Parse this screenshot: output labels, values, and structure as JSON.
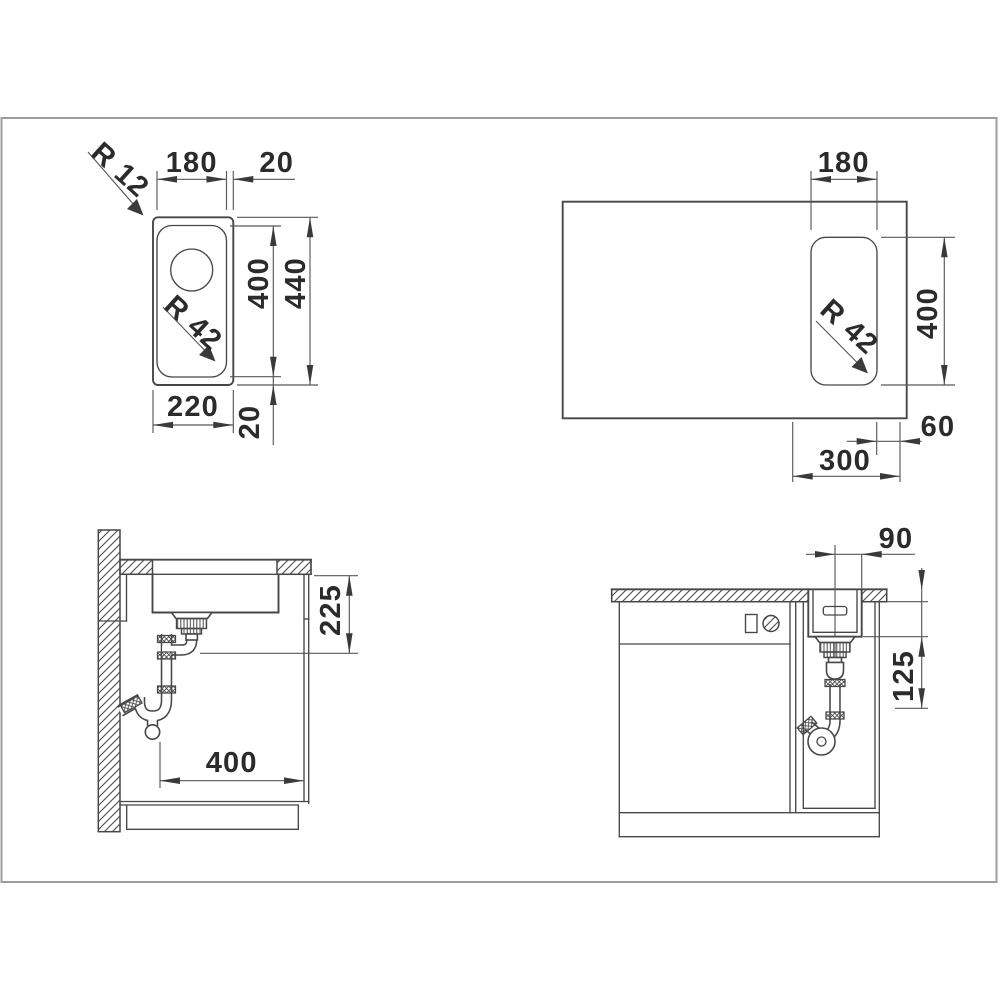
{
  "colors": {
    "line": "#474747",
    "dimension": "#585858",
    "text": "#2b2b2b",
    "panel_border": "#9d9d9d",
    "background": "#ffffff"
  },
  "views": {
    "top": {
      "title": "sink plan view",
      "dims": {
        "bowl_width": "180",
        "rim_offset_right": "20",
        "outer_corner_radius": "R 12",
        "bowl_corner_radius": "R 42",
        "bowl_length": "400",
        "outer_length": "440",
        "outer_width": "220",
        "rim_offset_bottom": "20"
      }
    },
    "cutout": {
      "title": "worktop cutout view",
      "dims": {
        "cutout_width": "180",
        "cutout_corner_radius": "R 42",
        "cutout_length": "400",
        "edge_distance": "60",
        "cabinet_width": "300"
      }
    },
    "side": {
      "title": "side section view",
      "dims": {
        "install_depth": "225",
        "cabinet_clearance": "400"
      }
    },
    "front": {
      "title": "front section view",
      "dims": {
        "drain_offset": "90",
        "clearance_below_bowl": "125"
      }
    }
  }
}
